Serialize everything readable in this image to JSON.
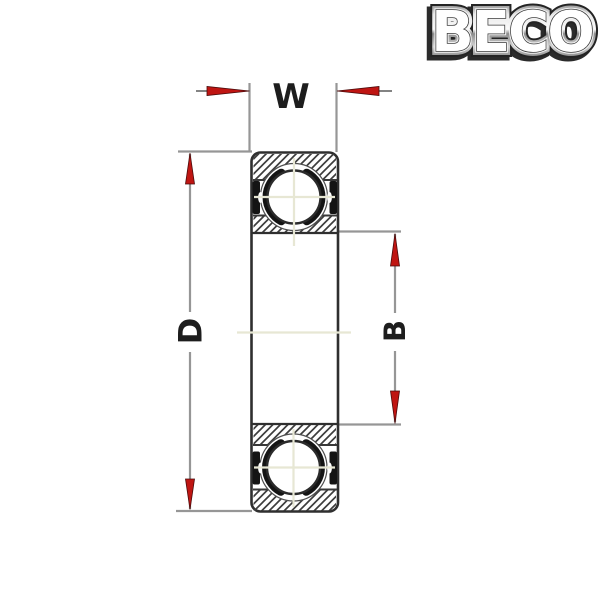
{
  "logo": {
    "text": "BECO"
  },
  "diagram": {
    "labels": {
      "width": "W",
      "outer_diameter": "D",
      "bore": "B"
    }
  },
  "colors": {
    "background": "#ffffff",
    "arrow_red": "#bf1512",
    "arrow_edge": "#4a0a0a",
    "drawing_line": "#2f2f2f",
    "dimension_line": "#969696",
    "centerline": "#e7e7d4",
    "hatch_line": "#3d3d3d",
    "label_text": "#1d1d1d"
  }
}
